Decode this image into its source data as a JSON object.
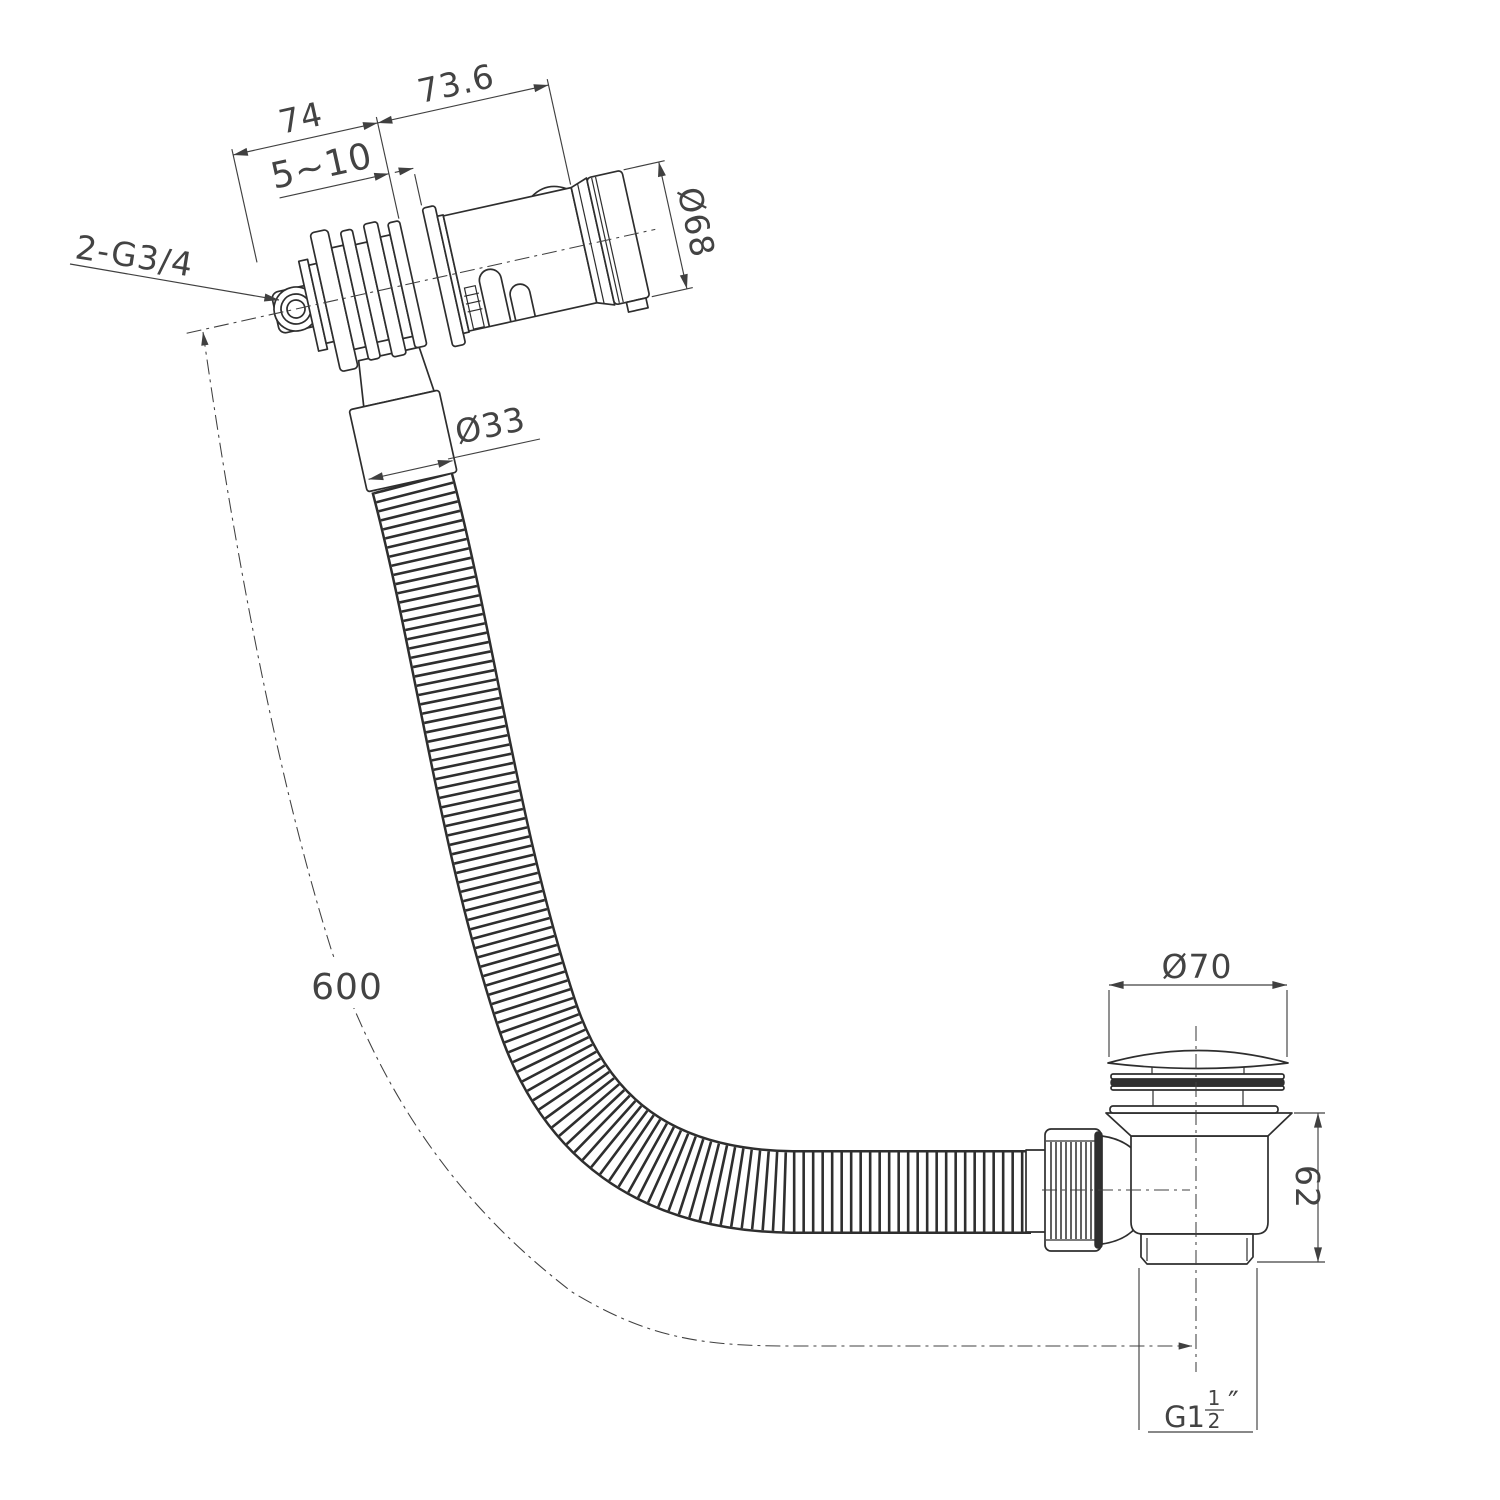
{
  "drawing": {
    "type": "technical-dimension-drawing",
    "subject": "bath-filler-overflow-with-flexible-hose-and-click-waste",
    "dimensions": {
      "behind_wall_length": "74",
      "front_body_length": "73.6",
      "wall_thickness_range": "5∼10",
      "overflow_cap_diameter": "Ø68",
      "inlet_thread": "2-G3/4",
      "hose_diameter": "Ø33",
      "hose_length": "600",
      "waste_flange_diameter": "Ø70",
      "waste_body_height": "62",
      "outlet_thread_prefix": "G1",
      "outlet_thread_numerator": "1",
      "outlet_thread_denominator": "2",
      "outlet_thread_unit": "″"
    },
    "colors": {
      "background": "#ffffff",
      "geometry_line": "#2e2e2e",
      "dimension_line": "#404040",
      "text": "#434343"
    }
  }
}
